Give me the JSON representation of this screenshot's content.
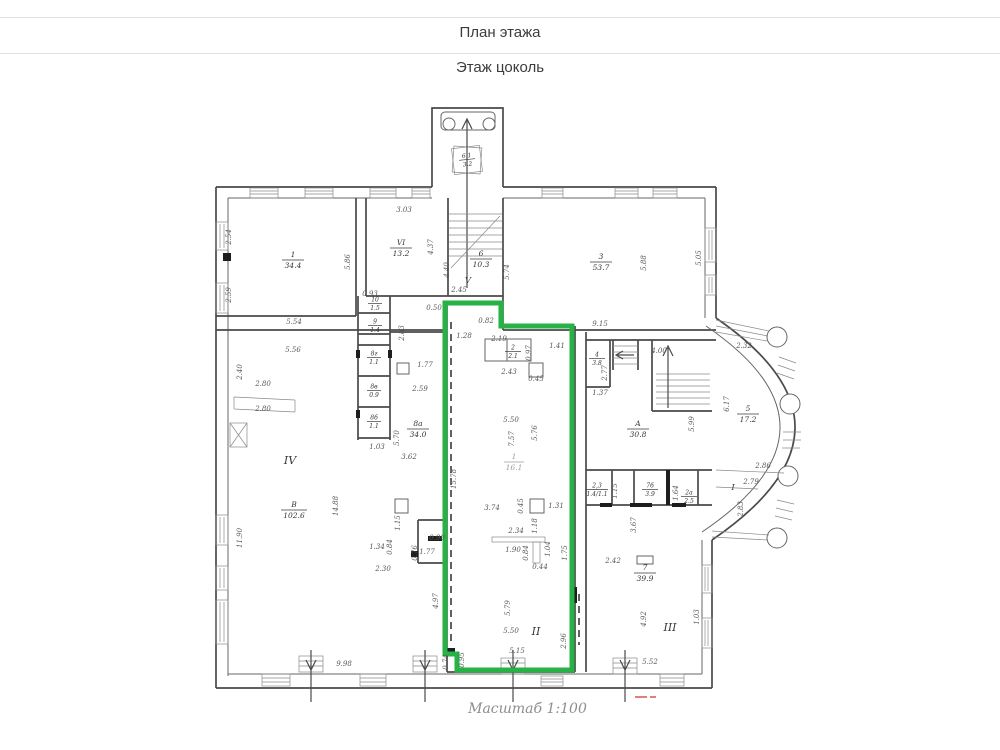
{
  "header": {
    "title": "План этажа",
    "subtitle": "Этаж цоколь"
  },
  "footer": {
    "scale_label": "Масштаб 1:100"
  },
  "colors": {
    "highlight_green": "#26b244",
    "wall": "#4a4a4a",
    "dim_text": "#585858",
    "red_mark": "#cc3333"
  },
  "plan": {
    "zones": [
      "IV",
      "II",
      "III",
      "V",
      "I"
    ],
    "rooms": [
      {
        "number": "6.1",
        "area": "3.2"
      },
      {
        "number": "1",
        "area": "34.4"
      },
      {
        "number": "VI",
        "area": "13.2"
      },
      {
        "number": "6",
        "area": "10.3"
      },
      {
        "number": "3",
        "area": "53.7"
      },
      {
        "number": "2",
        "area": "2.1"
      },
      {
        "number": "4",
        "area": "3.8"
      },
      {
        "number": "А",
        "area": "30.8"
      },
      {
        "number": "5",
        "area": "17.2"
      },
      {
        "number": "10",
        "area": "1.5"
      },
      {
        "number": "9",
        "area": "1.4"
      },
      {
        "number": "8г",
        "area": "1.1"
      },
      {
        "number": "8в",
        "area": "0.9"
      },
      {
        "number": "8б",
        "area": "1.1"
      },
      {
        "number": "8а",
        "area": "34.0"
      },
      {
        "number": "В",
        "area": "102.6"
      },
      {
        "number": "1",
        "area": "16.1"
      },
      {
        "number": "2,3",
        "area": "1.4/1.1"
      },
      {
        "number": "7б",
        "area": "3.9"
      },
      {
        "number": "2а",
        "area": "2.5"
      },
      {
        "number": "7",
        "area": "39.9"
      }
    ],
    "dims": [
      "3.03",
      "4.37",
      "4.40",
      "5.74",
      "2.45",
      "5.86",
      "2.54",
      "2.59",
      "5.54",
      "5.56",
      "5.88",
      "5.05",
      "9.15",
      "0.50",
      "0.93",
      "0.82",
      "2.83",
      "1.28",
      "2.19",
      "0.97",
      "1.41",
      "2.43",
      "0.45",
      "2.77",
      "4.00",
      "1.37",
      "2.32",
      "1.77",
      "2.59",
      "2.80",
      "2.80",
      "2.40",
      "1.03",
      "5.70",
      "3.62",
      "5.50",
      "7.57",
      "5.76",
      "15.78",
      "3.74",
      "0.45",
      "1.31",
      "1.18",
      "2.34",
      "1.90",
      "0.84",
      "1.04",
      "0.44",
      "1.75",
      "5.79",
      "5.50",
      "5.15",
      "2.96",
      "0.74",
      "0.95",
      "4.97",
      "14.88",
      "11.90",
      "1.34",
      "0.84",
      "1.15",
      "0.90",
      "0.76",
      "1.77",
      "2.30",
      "9.98",
      "1.15",
      "1.64",
      "3.67",
      "2.42",
      "4.92",
      "1.03",
      "5.52",
      "5.99",
      "6.17",
      "2.86",
      "2.79",
      "2.83"
    ]
  }
}
